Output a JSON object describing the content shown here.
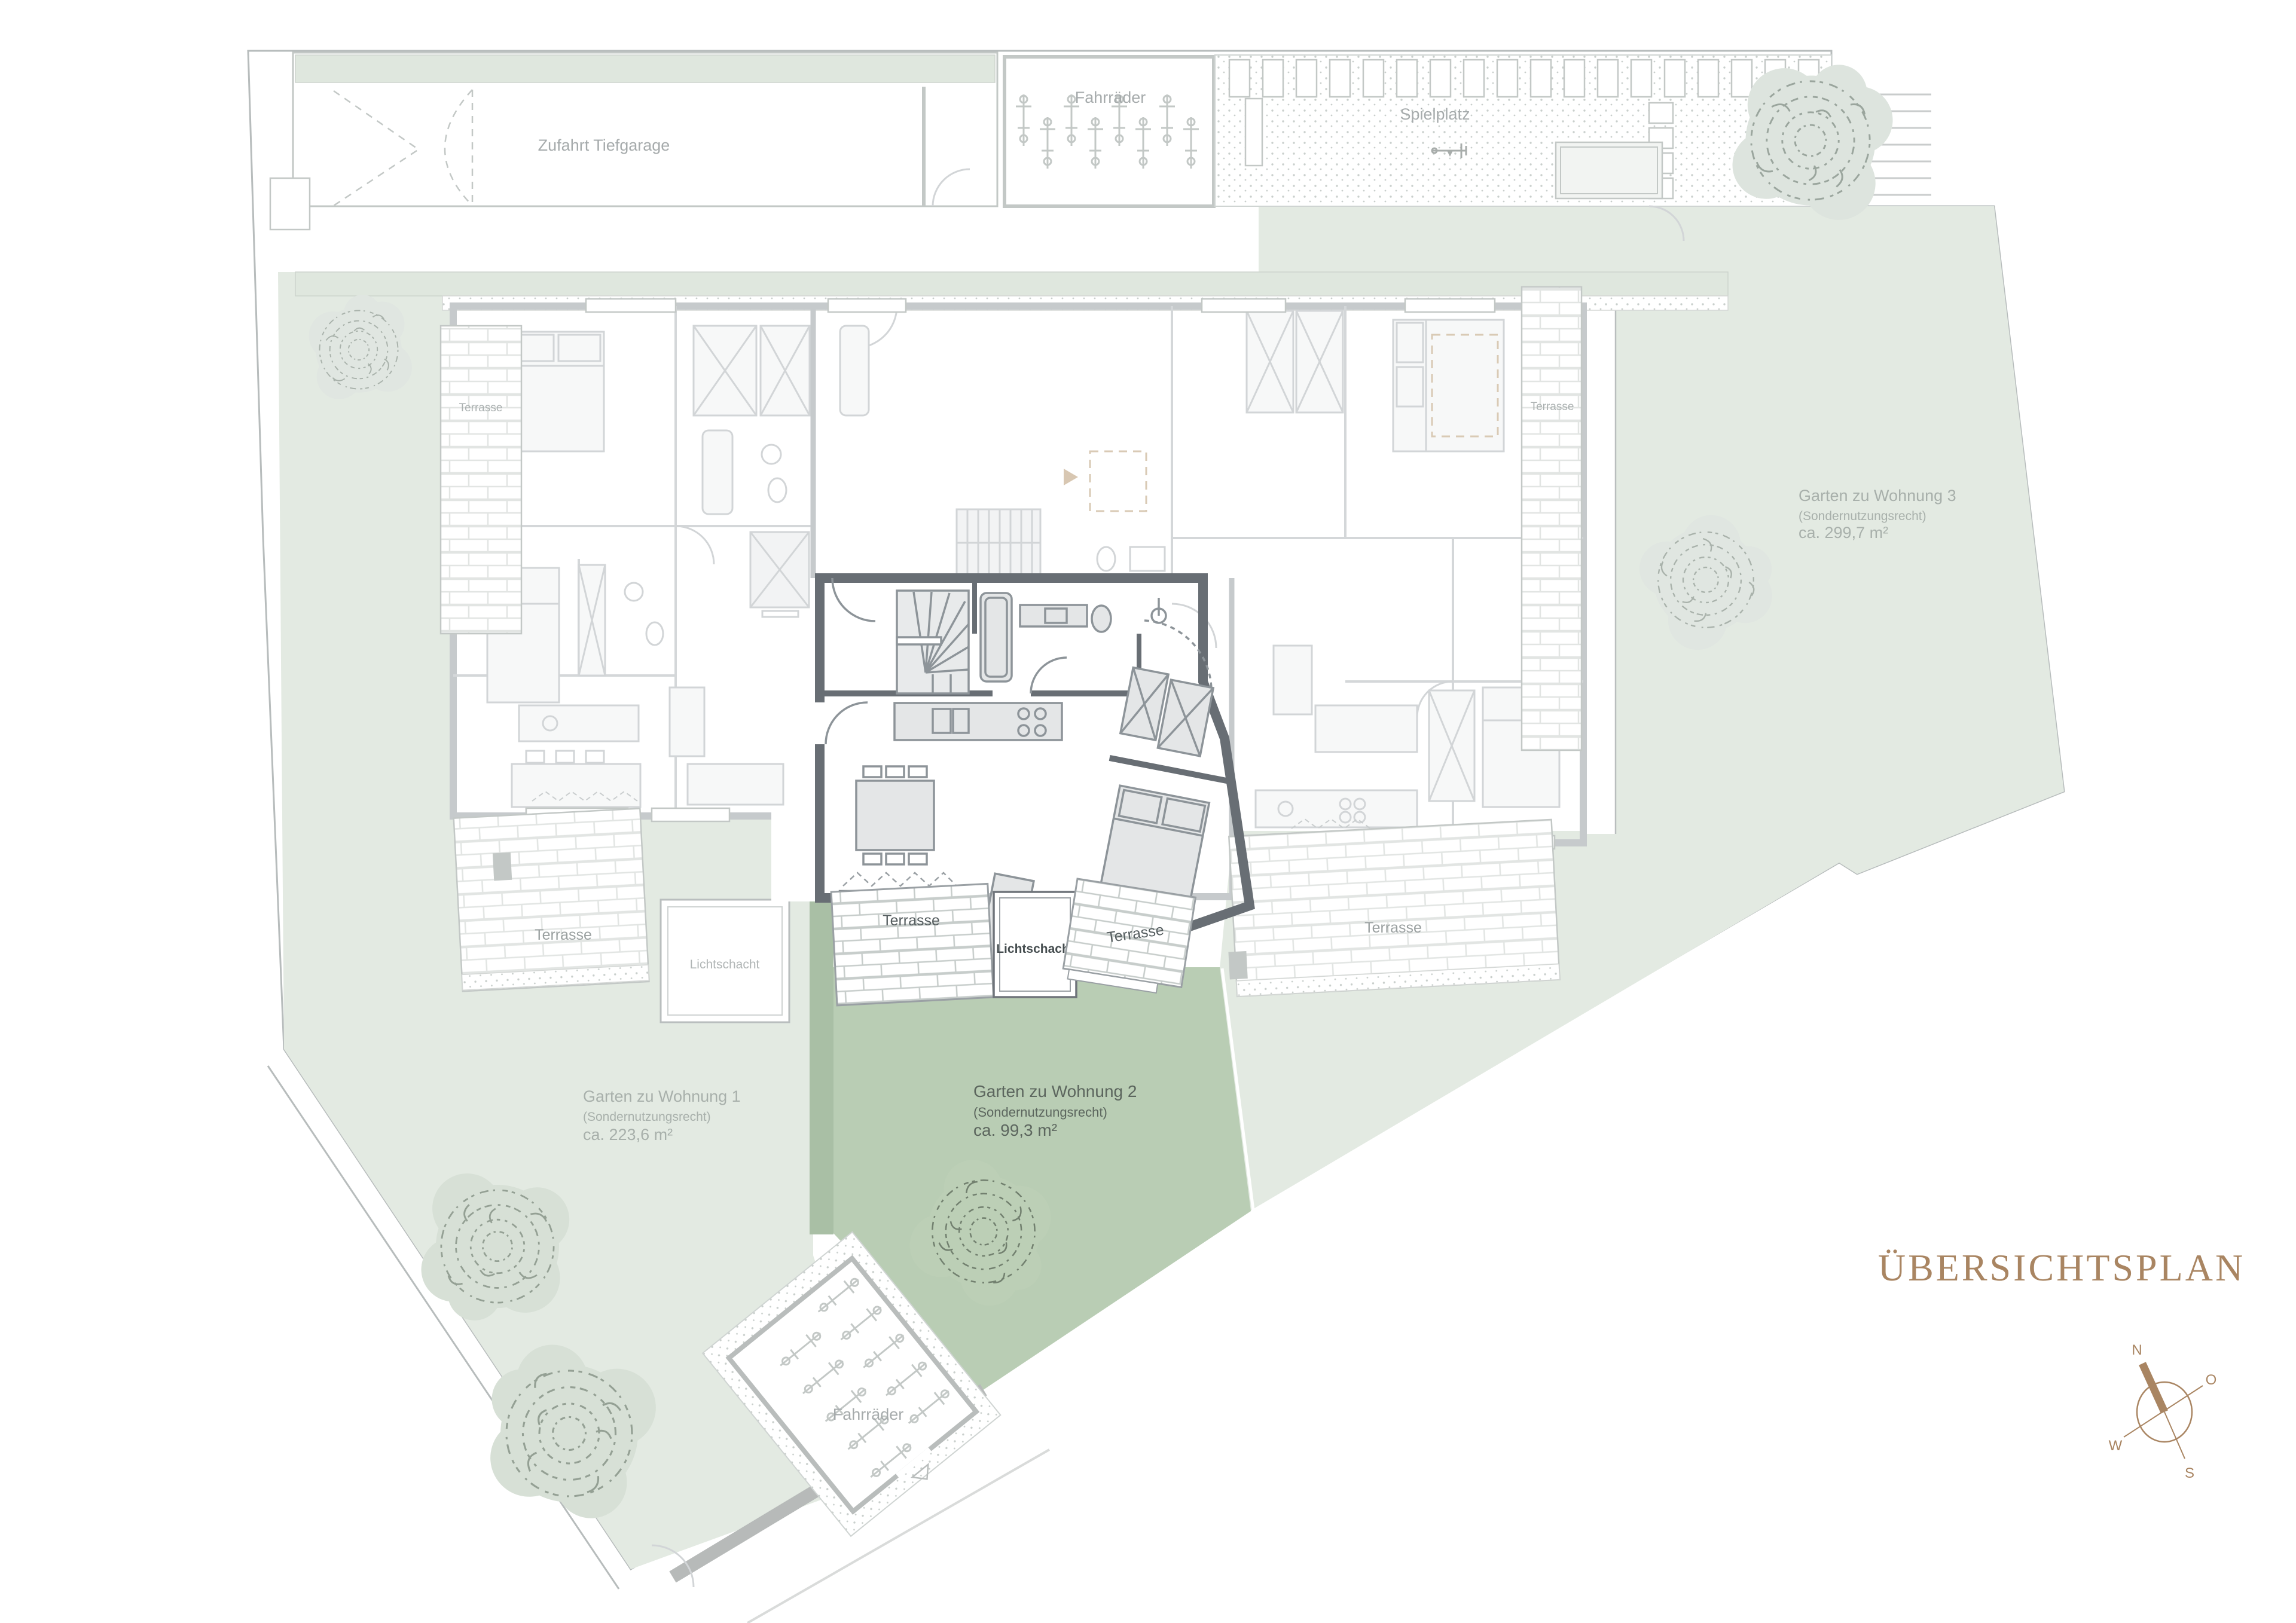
{
  "title": "ÜBERSICHTSPLAN",
  "labels": {
    "zufahrt": "Zufahrt Tiefgarage",
    "fahrraeder": "Fahrräder",
    "spielplatz": "Spielplatz",
    "terrasse": "Terrasse",
    "lichtschacht": "Lichtschacht"
  },
  "gardens": [
    {
      "name": "Garten zu Wohnung 1",
      "subtitle": "(Sondernutzungsrecht)",
      "area": "ca. 223,6 m²",
      "highlighted": false
    },
    {
      "name": "Garten zu Wohnung 2",
      "subtitle": "(Sondernutzungsrecht)",
      "area": "ca. 99,3 m²",
      "highlighted": true
    },
    {
      "name": "Garten zu Wohnung 3",
      "subtitle": "(Sondernutzungsrecht)",
      "area": "ca. 299,7 m²",
      "highlighted": false
    }
  ],
  "compass": {
    "n": "N",
    "o": "O",
    "s": "S",
    "w": "W"
  },
  "colors": {
    "accent_brown": "#a98562",
    "garden_highlight": "#b9cdb4",
    "garden_faded": "#e3eae2",
    "green_strip": "#dfe7de",
    "wall_highlight": "#686e74",
    "wall_faded": "#c6cacc",
    "unit_floor": "#d8dbdd"
  }
}
